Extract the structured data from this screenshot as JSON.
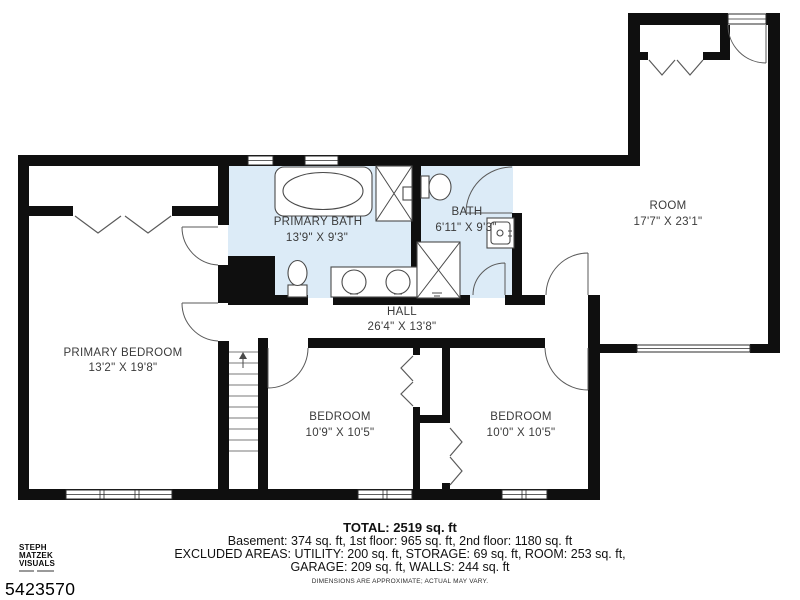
{
  "colors": {
    "wall": "#0f0f0f",
    "bath_fill": "#dcebf7",
    "label_text": "#3b3b3b",
    "background": "#ffffff"
  },
  "rooms": {
    "primary_bedroom": {
      "name": "PRIMARY BEDROOM",
      "dims": "13'2\" X 19'8\""
    },
    "primary_bath": {
      "name": "PRIMARY BATH",
      "dims": "13'9\" X 9'3\""
    },
    "bath": {
      "name": "BATH",
      "dims": "6'11\" X 9'3\""
    },
    "room": {
      "name": "ROOM",
      "dims": "17'7\" X 23'1\""
    },
    "hall": {
      "name": "HALL",
      "dims": "26'4\" X 13'8\""
    },
    "bedroom_left": {
      "name": "BEDROOM",
      "dims": "10'9\" X 10'5\""
    },
    "bedroom_right": {
      "name": "BEDROOM",
      "dims": "10'0\" X 10'5\""
    }
  },
  "footer": {
    "total": "TOTAL: 2519 sq. ft",
    "line1": "Basement: 374 sq. ft, 1st floor: 965 sq. ft, 2nd floor: 1180 sq. ft",
    "line2": "EXCLUDED AREAS: UTILITY: 200 sq. ft, STORAGE: 69 sq. ft, ROOM: 253 sq. ft,",
    "line3": "GARAGE: 209 sq. ft, WALLS: 244 sq. ft",
    "disclaimer": "DIMENSIONS ARE APPROXIMATE; ACTUAL MAY VARY."
  },
  "branding": {
    "logo_line1": "STEPH",
    "logo_line2": "MATZEK",
    "logo_line3": "VISUALS",
    "listing_number": "5423570"
  }
}
